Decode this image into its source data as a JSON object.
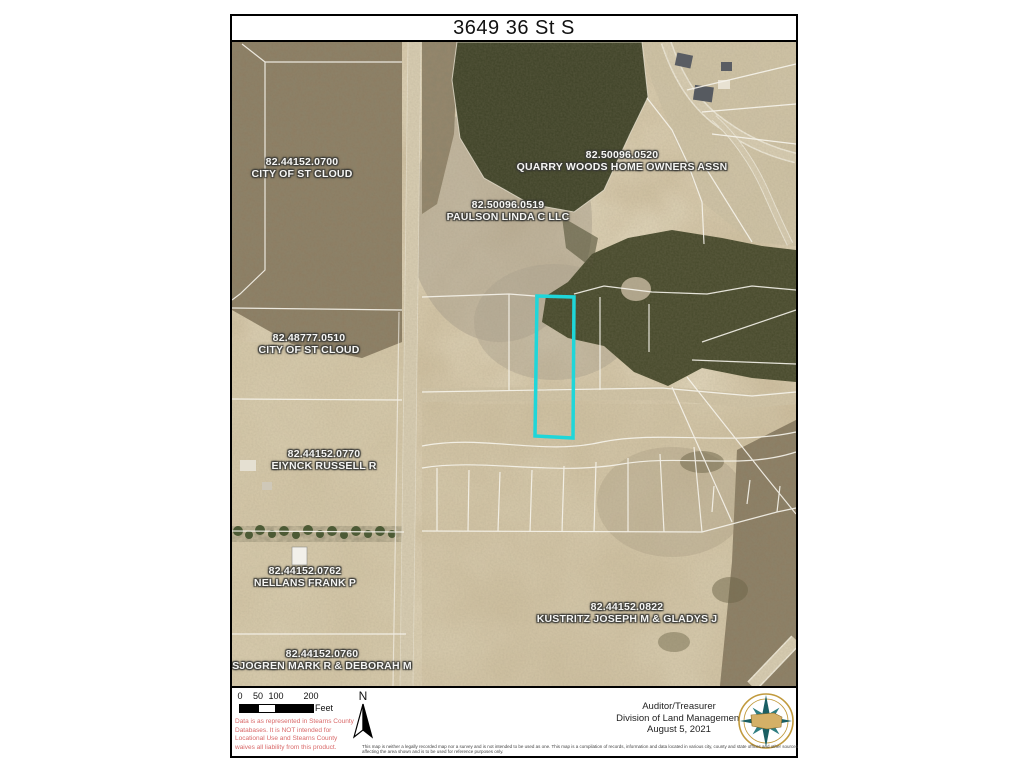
{
  "title": "3649 36 St S",
  "map": {
    "highlight_color": "#1fd6d9",
    "parcels": [
      {
        "id": "82.44152.0700",
        "owner": "CITY OF ST CLOUD"
      },
      {
        "id": "82.50096.0520",
        "owner": "QUARRY WOODS HOME OWNERS ASSN"
      },
      {
        "id": "82.50096.0519",
        "owner": "PAULSON LINDA C LLC"
      },
      {
        "id": "82.48777.0510",
        "owner": "CITY OF ST CLOUD"
      },
      {
        "id": "82.44152.0770",
        "owner": "EIYNCK RUSSELL R"
      },
      {
        "id": "82.44152.0762",
        "owner": "NELLANS FRANK P"
      },
      {
        "id": "82.44152.0822",
        "owner": "KUSTRITZ JOSEPH M & GLADYS J"
      },
      {
        "id": "82.44152.0760",
        "owner": "SJOGREN MARK R & DEBORAH M"
      }
    ]
  },
  "footer": {
    "scale_ticks": [
      "0",
      "50",
      "100",
      "200"
    ],
    "scale_unit": "Feet",
    "north_label": "N",
    "disclaimer": "Data is as represented in Stearns County Databases. It is NOT intended for Locational Use and Stearns County waives all liability from this product.",
    "attribution": {
      "line1": "Auditor/Treasurer",
      "line2": "Division of Land Management",
      "line3": "August 5, 2021"
    },
    "fine_print": "This map is neither a legally recorded map nor a survey and is not intended to be used as one. This map is a compilation of records, information and data located in various city, county and state offices and other sources affecting the area shown and is to be used for reference purposes only.",
    "disclaimer_color": "#d96a6a"
  }
}
